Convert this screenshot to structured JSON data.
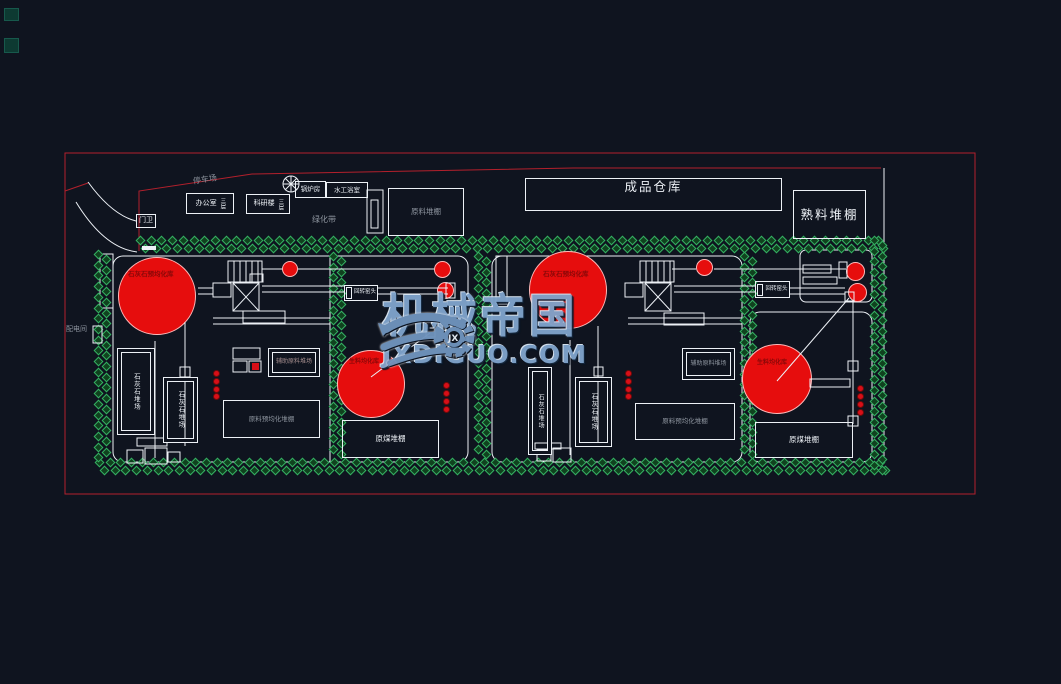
{
  "watermark": {
    "title": "机械帝国",
    "domain": "JXDIGUO.COM",
    "logo_monogram": "JX"
  },
  "plant": {
    "finished_warehouse": "成品仓库",
    "clinker_shed": "熟料堆棚",
    "raw_material_shed": "原料堆棚",
    "office": "办公室",
    "office_note": "三层",
    "research_building": "科研楼",
    "research_note": "三层",
    "boiler_room": "锅炉房",
    "bath_house": "水工浴室",
    "gate_guard": "门卫",
    "parking_lot": "停车场",
    "green_belt": "绿化带",
    "power_room": "配电间",
    "limestone_preblending_silo": "石灰石预均化库",
    "limestone_yard": "石灰石堆场",
    "aux_material_yard": "辅助原料堆场",
    "preblending_shed": "原料预均化堆棚",
    "raw_meal_silo": "生料均化库",
    "coal_shed": "原煤堆棚",
    "kiln_head": "回转窑头"
  },
  "colors": {
    "background": "#0f141f",
    "line_white": "#edf1f6",
    "boundary_red": "#b3202c",
    "fill_red": "#e60d0d",
    "tree_green": "#35b063",
    "watermark_blue": "#7fa3cb"
  }
}
